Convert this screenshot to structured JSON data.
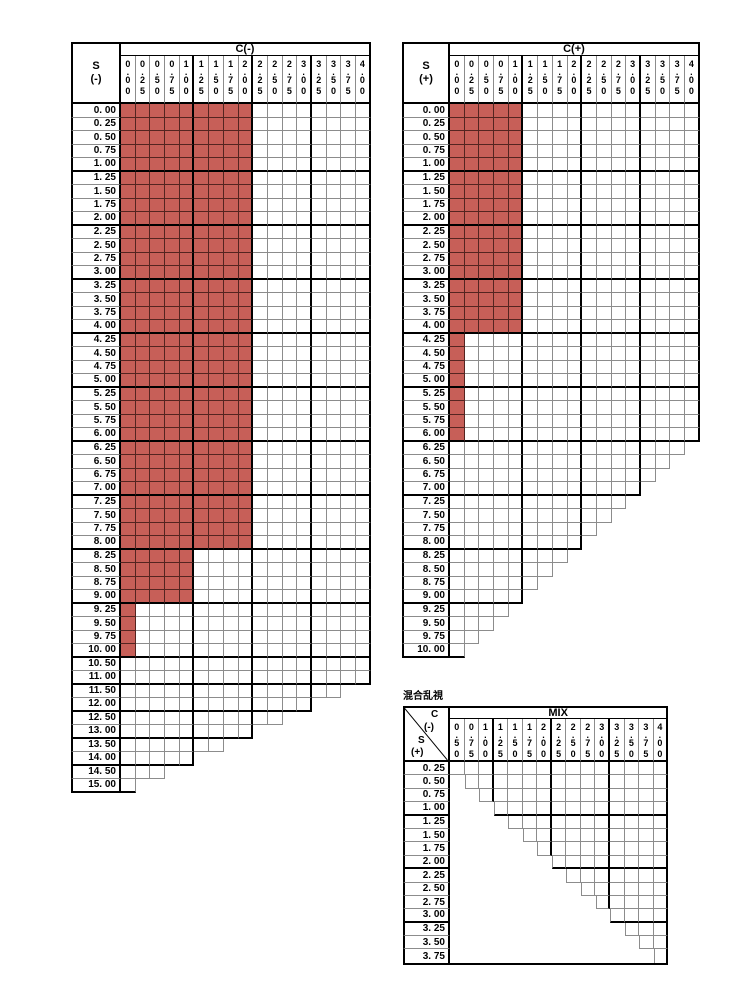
{
  "colors": {
    "available_fill": "#c75f58",
    "available_grid_line": "#542420",
    "grid_line": "#8c8c8c",
    "heavy_line": "#000000",
    "background": "#ffffff",
    "text": "#000000"
  },
  "tables": {
    "minus": {
      "corner": [
        "S",
        "(-)"
      ],
      "band": "C(-)",
      "columns": [
        "0.00",
        "0.25",
        "0.50",
        "0.75",
        "1.00",
        "1.25",
        "1.50",
        "1.75",
        "2.00",
        "2.25",
        "2.50",
        "2.75",
        "3.00",
        "3.25",
        "3.50",
        "3.75",
        "4.00"
      ],
      "rows": [
        [
          "0. 00",
          17,
          9
        ],
        [
          "0. 25",
          17,
          9
        ],
        [
          "0. 50",
          17,
          9
        ],
        [
          "0. 75",
          17,
          9
        ],
        [
          "1. 00",
          17,
          9
        ],
        [
          "1. 25",
          17,
          9
        ],
        [
          "1. 50",
          17,
          9
        ],
        [
          "1. 75",
          17,
          9
        ],
        [
          "2. 00",
          17,
          9
        ],
        [
          "2. 25",
          17,
          9
        ],
        [
          "2. 50",
          17,
          9
        ],
        [
          "2. 75",
          17,
          9
        ],
        [
          "3. 00",
          17,
          9
        ],
        [
          "3. 25",
          17,
          9
        ],
        [
          "3. 50",
          17,
          9
        ],
        [
          "3. 75",
          17,
          9
        ],
        [
          "4. 00",
          17,
          9
        ],
        [
          "4. 25",
          17,
          9
        ],
        [
          "4. 50",
          17,
          9
        ],
        [
          "4. 75",
          17,
          9
        ],
        [
          "5. 00",
          17,
          9
        ],
        [
          "5. 25",
          17,
          9
        ],
        [
          "5. 50",
          17,
          9
        ],
        [
          "5. 75",
          17,
          9
        ],
        [
          "6. 00",
          17,
          9
        ],
        [
          "6. 25",
          17,
          9
        ],
        [
          "6. 50",
          17,
          9
        ],
        [
          "6. 75",
          17,
          9
        ],
        [
          "7. 00",
          17,
          9
        ],
        [
          "7. 25",
          17,
          9
        ],
        [
          "7. 50",
          17,
          9
        ],
        [
          "7. 75",
          17,
          9
        ],
        [
          "8. 00",
          17,
          9
        ],
        [
          "8. 25",
          17,
          5
        ],
        [
          "8. 50",
          17,
          5
        ],
        [
          "8. 75",
          17,
          5
        ],
        [
          "9. 00",
          17,
          5
        ],
        [
          "9. 25",
          17,
          1
        ],
        [
          "9. 50",
          17,
          1
        ],
        [
          "9. 75",
          17,
          1
        ],
        [
          "10. 00",
          17,
          1
        ],
        [
          "10. 50",
          17,
          0
        ],
        [
          "11. 00",
          17,
          0
        ],
        [
          "11. 50",
          15,
          0
        ],
        [
          "12. 00",
          13,
          0
        ],
        [
          "12. 50",
          11,
          0
        ],
        [
          "13. 00",
          9,
          0
        ],
        [
          "13. 50",
          7,
          0
        ],
        [
          "14. 00",
          5,
          0
        ],
        [
          "14. 50",
          3,
          0
        ],
        [
          "15. 00",
          1,
          0
        ]
      ]
    },
    "plus": {
      "corner": [
        "S",
        "(+)"
      ],
      "band": "C(+)",
      "columns": [
        "0.00",
        "0.25",
        "0.50",
        "0.75",
        "1.00",
        "1.25",
        "1.50",
        "1.75",
        "2.00",
        "2.25",
        "2.50",
        "2.75",
        "3.00",
        "3.25",
        "3.50",
        "3.75",
        "4.00"
      ],
      "rows": [
        [
          "0. 00",
          17,
          5
        ],
        [
          "0. 25",
          17,
          5
        ],
        [
          "0. 50",
          17,
          5
        ],
        [
          "0. 75",
          17,
          5
        ],
        [
          "1. 00",
          17,
          5
        ],
        [
          "1. 25",
          17,
          5
        ],
        [
          "1. 50",
          17,
          5
        ],
        [
          "1. 75",
          17,
          5
        ],
        [
          "2. 00",
          17,
          5
        ],
        [
          "2. 25",
          17,
          5
        ],
        [
          "2. 50",
          17,
          5
        ],
        [
          "2. 75",
          17,
          5
        ],
        [
          "3. 00",
          17,
          5
        ],
        [
          "3. 25",
          17,
          5
        ],
        [
          "3. 50",
          17,
          5
        ],
        [
          "3. 75",
          17,
          5
        ],
        [
          "4. 00",
          17,
          5
        ],
        [
          "4. 25",
          17,
          1
        ],
        [
          "4. 50",
          17,
          1
        ],
        [
          "4. 75",
          17,
          1
        ],
        [
          "5. 00",
          17,
          1
        ],
        [
          "5. 25",
          17,
          1
        ],
        [
          "5. 50",
          17,
          1
        ],
        [
          "5. 75",
          17,
          1
        ],
        [
          "6. 00",
          17,
          1
        ],
        [
          "6. 25",
          16,
          0
        ],
        [
          "6. 50",
          15,
          0
        ],
        [
          "6. 75",
          14,
          0
        ],
        [
          "7. 00",
          13,
          0
        ],
        [
          "7. 25",
          12,
          0
        ],
        [
          "7. 50",
          11,
          0
        ],
        [
          "7. 75",
          10,
          0
        ],
        [
          "8. 00",
          9,
          0
        ],
        [
          "8. 25",
          8,
          0
        ],
        [
          "8. 50",
          7,
          0
        ],
        [
          "8. 75",
          6,
          0
        ],
        [
          "9. 00",
          5,
          0
        ],
        [
          "9. 25",
          4,
          0
        ],
        [
          "9. 50",
          3,
          0
        ],
        [
          "9. 75",
          2,
          0
        ],
        [
          "10. 00",
          1,
          0
        ]
      ]
    },
    "mix": {
      "title": "混合乱視",
      "corner": [
        "C",
        "(-)",
        "S",
        "(+)"
      ],
      "band": "MIX",
      "columns": [
        "0.50",
        "0.75",
        "1.00",
        "1.25",
        "1.50",
        "1.75",
        "2.00",
        "2.25",
        "2.50",
        "2.75",
        "3.00",
        "3.25",
        "3.50",
        "3.75",
        "4.00"
      ],
      "rows": [
        [
          "0. 25",
          15,
          0,
          0
        ],
        [
          "0. 50",
          14,
          0,
          1
        ],
        [
          "0. 75",
          13,
          0,
          2
        ],
        [
          "1. 00",
          12,
          0,
          3
        ],
        [
          "1. 25",
          11,
          0,
          4
        ],
        [
          "1. 50",
          10,
          0,
          5
        ],
        [
          "1. 75",
          9,
          0,
          6
        ],
        [
          "2. 00",
          8,
          0,
          7
        ],
        [
          "2. 25",
          7,
          0,
          8
        ],
        [
          "2. 50",
          6,
          0,
          9
        ],
        [
          "2. 75",
          5,
          0,
          10
        ],
        [
          "3. 00",
          4,
          0,
          11
        ],
        [
          "3. 25",
          3,
          0,
          12
        ],
        [
          "3. 50",
          2,
          0,
          13
        ],
        [
          "3. 75",
          1,
          0,
          14
        ]
      ]
    }
  }
}
